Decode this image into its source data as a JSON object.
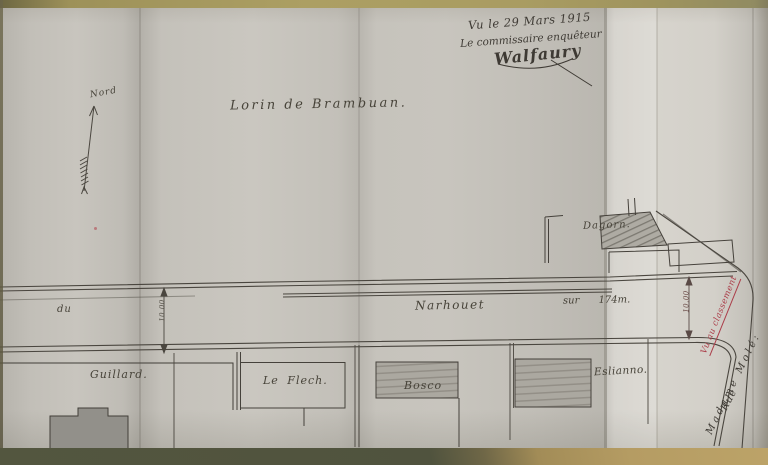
{
  "plan": {
    "title": "Lorin de Brambuan.",
    "north_label": "Nord",
    "stamp": {
      "line1": "Vu le 29 Mars 1915",
      "line2": "Le commissaire enquêteur",
      "signature": "Walfaury"
    },
    "road": {
      "prefix": "du",
      "name": "Narhouet",
      "length": "sur 174m.",
      "width_left": "10.00",
      "width_right": "10.00"
    },
    "parcels": {
      "dagorn": "Dagorn.",
      "guillard": "Guillard.",
      "leflech": "Le Flech.",
      "bosco": "Bosco",
      "eslianno": "Eslianno."
    },
    "margin_notes": {
      "red_note": "Vu au classement",
      "owner": "Madame Molé:",
      "street": "Rue"
    },
    "colors": {
      "ink": "#44403a",
      "red_ink": "#ab3d49",
      "paper": "#c4c1ba",
      "table": "#a8975f"
    }
  }
}
